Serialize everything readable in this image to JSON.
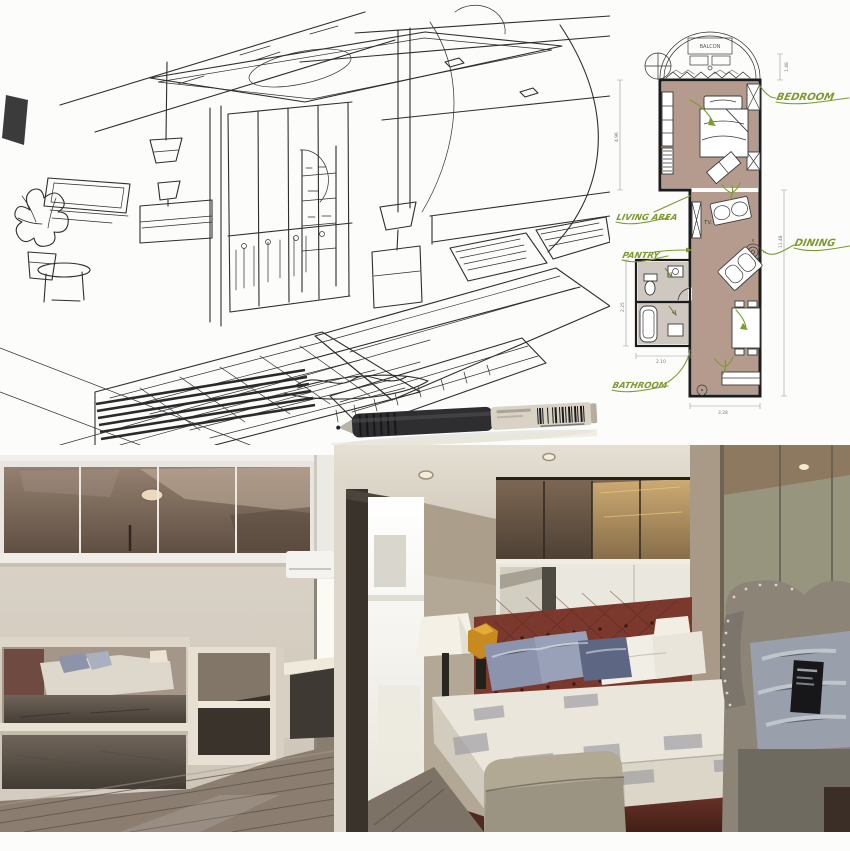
{
  "collage": {
    "kind": "interior-design-presentation",
    "scene": "bedroom suite sketch, floor plan and photos"
  },
  "floorplan": {
    "labels": {
      "balcony": "BALCON",
      "bedroom": "BEDROOM",
      "living": "LIVING AREA",
      "pantry": "PANTRY",
      "dining": "DINING",
      "bathroom": "BATHROOM",
      "tv": "TV."
    },
    "dims": {
      "balcony_depth": "1.48",
      "bedroom_len": "4.96",
      "living_len": "11.48",
      "bath_w": "2.25",
      "bath_l": "2.10",
      "unit_w": "3.28"
    },
    "colors": {
      "room_fill": "#b59b8d",
      "bath_fill": "#cfc8c0",
      "label_green": "#7c9a2e",
      "wall": "#1c1c1c"
    }
  },
  "sketch": {
    "colors": {
      "ink": "#2e2e2e",
      "paper": "#fcfcfb"
    }
  },
  "pen": {
    "colors": {
      "cap": "#2e2d30",
      "barrel": "#d9d3c6"
    }
  },
  "photo_left": {
    "colors": {
      "frame": "#e9e6df",
      "bronze": "#7d6a5b",
      "wall": "#d6cec3",
      "mirror": "#a5968a",
      "shelf": "#e6dfd2",
      "floor": "#8b7e71"
    }
  },
  "photo_right": {
    "colors": {
      "ceiling": "#ded8cc",
      "window": "#f8f6ef",
      "wall": "#b3a795",
      "bronze": "#6f5b49",
      "wardrobe": "#eae7df",
      "headboard": "#7a392c",
      "mattress": "#eae6dc",
      "pillow_blue": "#8b93ad",
      "bed_base": "#5f2f24",
      "ottoman": "#b2a995",
      "chair": "#8d8478",
      "mirror": "#98957f",
      "floor": "#7c7265"
    }
  }
}
